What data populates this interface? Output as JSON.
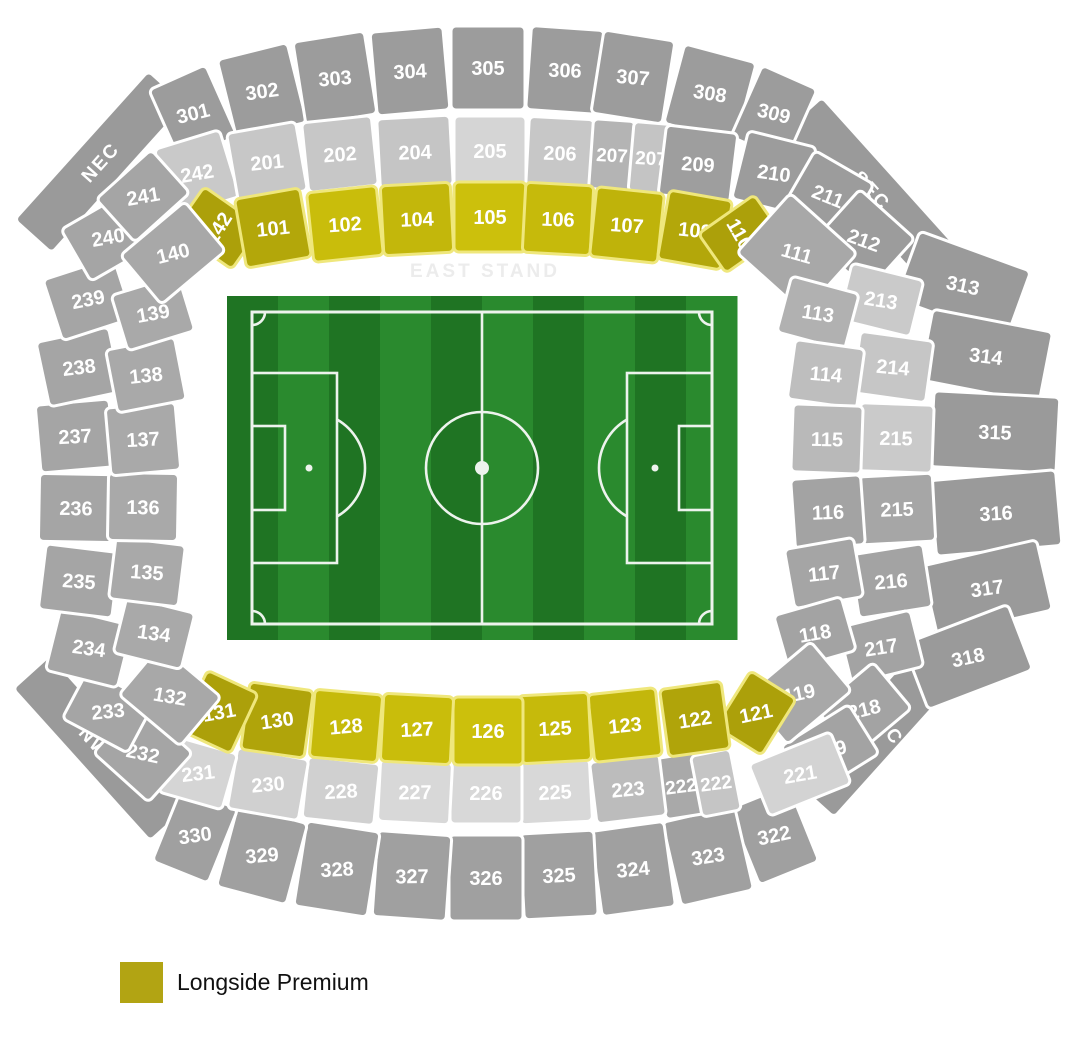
{
  "legend": {
    "label": "Longside Premium",
    "swatch_color": "#B2A413"
  },
  "east_stand_label": {
    "text": "EAST STAND",
    "x": 485,
    "y": 277,
    "color": "#ECECEC",
    "font_size": 19,
    "letter_spacing": 3
  },
  "pitch": {
    "x": 227,
    "y": 296,
    "w": 510,
    "h": 344,
    "stripes": 10,
    "stripe_dark": "#1F7423",
    "stripe_light": "#2A8A2E",
    "line_color": "#EDF3ED"
  },
  "colors": {
    "section_border": "#FFFFFF",
    "premium_border": "#EFE77C",
    "label_color": "#FFFFFF"
  },
  "sections": [
    {
      "id": "nec",
      "label": "NEC",
      "x": 100,
      "y": 162,
      "w": 200,
      "h": 50,
      "rot": -48,
      "lrot": -48,
      "fill": "#9A9A9A",
      "fs": 19,
      "ls": 2,
      "corner": true
    },
    {
      "id": "sec",
      "label": "SEC",
      "x": 872,
      "y": 190,
      "w": 205,
      "h": 50,
      "rot": 48,
      "lrot": 48,
      "fill": "#9A9A9A",
      "fs": 19,
      "ls": 2,
      "corner": true
    },
    {
      "id": "nwc",
      "label": "NWC",
      "x": 100,
      "y": 748,
      "w": 205,
      "h": 50,
      "rot": 48,
      "lrot": 48,
      "fill": "#9A9A9A",
      "fs": 19,
      "ls": 2,
      "corner": true
    },
    {
      "id": "swc",
      "label": "SWC",
      "x": 885,
      "y": 722,
      "w": 210,
      "h": 52,
      "rot": -48,
      "lrot": 55,
      "fill": "#9A9A9A",
      "fs": 19,
      "ls": 2,
      "corner": true
    },
    {
      "id": "301",
      "label": "301",
      "x": 193,
      "y": 113,
      "w": 62,
      "h": 78,
      "rot": -24,
      "lrot": -14,
      "fill": "#9C9C9C"
    },
    {
      "id": "302",
      "label": "302",
      "x": 262,
      "y": 91,
      "w": 72,
      "h": 82,
      "rot": -14,
      "lrot": -8,
      "fill": "#9C9C9C"
    },
    {
      "id": "303",
      "label": "303",
      "x": 335,
      "y": 78,
      "w": 72,
      "h": 84,
      "rot": -9,
      "lrot": -5,
      "fill": "#9C9C9C"
    },
    {
      "id": "304",
      "label": "304",
      "x": 410,
      "y": 71,
      "w": 73,
      "h": 84,
      "rot": -5,
      "lrot": -3,
      "fill": "#9C9C9C"
    },
    {
      "id": "305",
      "label": "305",
      "x": 488,
      "y": 68,
      "w": 74,
      "h": 84,
      "rot": 0,
      "lrot": 0,
      "fill": "#9C9C9C"
    },
    {
      "id": "306",
      "label": "306",
      "x": 565,
      "y": 70,
      "w": 73,
      "h": 84,
      "rot": 4,
      "lrot": 2,
      "fill": "#9C9C9C"
    },
    {
      "id": "307",
      "label": "307",
      "x": 633,
      "y": 77,
      "w": 72,
      "h": 84,
      "rot": 9,
      "lrot": 5,
      "fill": "#9C9C9C"
    },
    {
      "id": "308",
      "label": "308",
      "x": 710,
      "y": 93,
      "w": 74,
      "h": 82,
      "rot": 15,
      "lrot": 9,
      "fill": "#9C9C9C"
    },
    {
      "id": "309",
      "label": "309",
      "x": 774,
      "y": 113,
      "w": 60,
      "h": 78,
      "rot": 24,
      "lrot": 14,
      "fill": "#9C9C9C"
    },
    {
      "id": "313",
      "label": "313",
      "x": 963,
      "y": 285,
      "w": 118,
      "h": 72,
      "rot": 20,
      "lrot": 12,
      "fill": "#9A9A9A"
    },
    {
      "id": "314",
      "label": "314",
      "x": 986,
      "y": 356,
      "w": 122,
      "h": 72,
      "rot": 11,
      "lrot": 7,
      "fill": "#9A9A9A"
    },
    {
      "id": "315",
      "label": "315",
      "x": 995,
      "y": 432,
      "w": 126,
      "h": 76,
      "rot": 3,
      "lrot": 2,
      "fill": "#9A9A9A"
    },
    {
      "id": "316",
      "label": "316",
      "x": 996,
      "y": 513,
      "w": 126,
      "h": 76,
      "rot": -5,
      "lrot": -3,
      "fill": "#9A9A9A"
    },
    {
      "id": "317",
      "label": "317",
      "x": 987,
      "y": 588,
      "w": 118,
      "h": 72,
      "rot": -13,
      "lrot": -8,
      "fill": "#9A9A9A"
    },
    {
      "id": "318",
      "label": "318",
      "x": 968,
      "y": 657,
      "w": 112,
      "h": 70,
      "rot": -21,
      "lrot": -12,
      "fill": "#9A9A9A"
    },
    {
      "id": "322",
      "label": "322",
      "x": 774,
      "y": 835,
      "w": 64,
      "h": 82,
      "rot": -22,
      "lrot": -12,
      "fill": "#A0A0A0"
    },
    {
      "id": "323",
      "label": "323",
      "x": 708,
      "y": 856,
      "w": 74,
      "h": 86,
      "rot": -13,
      "lrot": -9,
      "fill": "#A0A0A0"
    },
    {
      "id": "324",
      "label": "324",
      "x": 633,
      "y": 869,
      "w": 74,
      "h": 86,
      "rot": -8,
      "lrot": -6,
      "fill": "#A0A0A0"
    },
    {
      "id": "325",
      "label": "325",
      "x": 559,
      "y": 875,
      "w": 74,
      "h": 86,
      "rot": -3,
      "lrot": -3,
      "fill": "#A0A0A0"
    },
    {
      "id": "326",
      "label": "326",
      "x": 486,
      "y": 878,
      "w": 74,
      "h": 86,
      "rot": 0,
      "lrot": 0,
      "fill": "#A0A0A0"
    },
    {
      "id": "327",
      "label": "327",
      "x": 412,
      "y": 876,
      "w": 74,
      "h": 86,
      "rot": 4,
      "lrot": -1,
      "fill": "#A0A0A0"
    },
    {
      "id": "328",
      "label": "328",
      "x": 337,
      "y": 869,
      "w": 74,
      "h": 86,
      "rot": 9,
      "lrot": -3,
      "fill": "#A0A0A0"
    },
    {
      "id": "329",
      "label": "329",
      "x": 262,
      "y": 855,
      "w": 72,
      "h": 84,
      "rot": 15,
      "lrot": -5,
      "fill": "#A0A0A0"
    },
    {
      "id": "330",
      "label": "330",
      "x": 195,
      "y": 835,
      "w": 60,
      "h": 80,
      "rot": 22,
      "lrot": -8,
      "fill": "#A0A0A0"
    },
    {
      "id": "242",
      "label": "242",
      "x": 197,
      "y": 173,
      "w": 68,
      "h": 70,
      "rot": -17,
      "lrot": -10,
      "fill": "#C9C9C9"
    },
    {
      "id": "201",
      "label": "201",
      "x": 267,
      "y": 162,
      "w": 70,
      "h": 70,
      "rot": -10,
      "lrot": -6,
      "fill": "#C7C7C7"
    },
    {
      "id": "202",
      "label": "202",
      "x": 340,
      "y": 154,
      "w": 70,
      "h": 70,
      "rot": -6,
      "lrot": -4,
      "fill": "#C7C7C7"
    },
    {
      "id": "204",
      "label": "204",
      "x": 415,
      "y": 152,
      "w": 73,
      "h": 70,
      "rot": -3,
      "lrot": -2,
      "fill": "#C5C5C5"
    },
    {
      "id": "205",
      "label": "205",
      "x": 490,
      "y": 151,
      "w": 72,
      "h": 70,
      "rot": 0,
      "lrot": 0,
      "fill": "#D5D5D5"
    },
    {
      "id": "206",
      "label": "206",
      "x": 560,
      "y": 153,
      "w": 65,
      "h": 70,
      "rot": 3,
      "lrot": 2,
      "fill": "#C7C7C7"
    },
    {
      "id": "207-1",
      "label": "207",
      "x": 612,
      "y": 155,
      "w": 42,
      "h": 70,
      "rot": 4,
      "lrot": 3,
      "fill": "#B4B4B4",
      "fs": 19
    },
    {
      "id": "207-2",
      "label": "207",
      "x": 651,
      "y": 158,
      "w": 40,
      "h": 70,
      "rot": 5,
      "lrot": 3,
      "fill": "#C4C4C4",
      "fs": 19
    },
    {
      "id": "209",
      "label": "209",
      "x": 698,
      "y": 164,
      "w": 72,
      "h": 70,
      "rot": 7,
      "lrot": 4,
      "fill": "#9E9E9E"
    },
    {
      "id": "210",
      "label": "210",
      "x": 774,
      "y": 173,
      "w": 70,
      "h": 70,
      "rot": 14,
      "lrot": 8,
      "fill": "#9C9C9C"
    },
    {
      "id": "211",
      "label": "211",
      "x": 828,
      "y": 196,
      "w": 68,
      "h": 66,
      "rot": 30,
      "lrot": 22,
      "fill": "#9C9C9C"
    },
    {
      "id": "212",
      "label": "212",
      "x": 864,
      "y": 240,
      "w": 74,
      "h": 70,
      "rot": 42,
      "lrot": 20,
      "fill": "#9C9C9C"
    },
    {
      "id": "213",
      "label": "213",
      "x": 881,
      "y": 300,
      "w": 74,
      "h": 58,
      "rot": 14,
      "lrot": 9,
      "fill": "#CACACA"
    },
    {
      "id": "214",
      "label": "214",
      "x": 893,
      "y": 367,
      "w": 74,
      "h": 62,
      "rot": 8,
      "lrot": 5,
      "fill": "#C6C6C6"
    },
    {
      "id": "215-1",
      "label": "215",
      "x": 896,
      "y": 438,
      "w": 74,
      "h": 68,
      "rot": 2,
      "lrot": 1,
      "fill": "#CACACA"
    },
    {
      "id": "215-2",
      "label": "215",
      "x": 897,
      "y": 509,
      "w": 74,
      "h": 68,
      "rot": -3,
      "lrot": -2,
      "fill": "#A6A6A6"
    },
    {
      "id": "216",
      "label": "216",
      "x": 891,
      "y": 581,
      "w": 74,
      "h": 64,
      "rot": -9,
      "lrot": -5,
      "fill": "#A3A3A3"
    },
    {
      "id": "217",
      "label": "217",
      "x": 881,
      "y": 647,
      "w": 74,
      "h": 58,
      "rot": -14,
      "lrot": -9,
      "fill": "#A3A3A3"
    },
    {
      "id": "218",
      "label": "218",
      "x": 864,
      "y": 709,
      "w": 74,
      "h": 60,
      "rot": -40,
      "lrot": -14,
      "fill": "#A3A3A3"
    },
    {
      "id": "219",
      "label": "219",
      "x": 830,
      "y": 750,
      "w": 80,
      "h": 58,
      "rot": -32,
      "lrot": -15,
      "fill": "#A3A3A3"
    },
    {
      "id": "221",
      "label": "221",
      "x": 800,
      "y": 774,
      "w": 88,
      "h": 56,
      "rot": -22,
      "lrot": -10,
      "fill": "#D3D3D3"
    },
    {
      "id": "222-1",
      "label": "222",
      "x": 681,
      "y": 786,
      "w": 40,
      "h": 62,
      "rot": -9,
      "lrot": -7,
      "fill": "#A9A9A9",
      "fs": 19
    },
    {
      "id": "222-2",
      "label": "222",
      "x": 716,
      "y": 783,
      "w": 40,
      "h": 62,
      "rot": -11,
      "lrot": -7,
      "fill": "#C5C5C5",
      "fs": 19
    },
    {
      "id": "223",
      "label": "223",
      "x": 628,
      "y": 789,
      "w": 70,
      "h": 62,
      "rot": -7,
      "lrot": -5,
      "fill": "#BCBCBC"
    },
    {
      "id": "225",
      "label": "225",
      "x": 555,
      "y": 792,
      "w": 72,
      "h": 62,
      "rot": -3,
      "lrot": -3,
      "fill": "#D8D8D8"
    },
    {
      "id": "226",
      "label": "226",
      "x": 486,
      "y": 793,
      "w": 72,
      "h": 62,
      "rot": 0,
      "lrot": 0,
      "fill": "#D8D8D8"
    },
    {
      "id": "227",
      "label": "227",
      "x": 415,
      "y": 792,
      "w": 72,
      "h": 62,
      "rot": 3,
      "lrot": -1,
      "fill": "#D8D8D8"
    },
    {
      "id": "228",
      "label": "228",
      "x": 341,
      "y": 791,
      "w": 72,
      "h": 62,
      "rot": 6,
      "lrot": -3,
      "fill": "#D0D0D0"
    },
    {
      "id": "230",
      "label": "230",
      "x": 268,
      "y": 784,
      "w": 72,
      "h": 62,
      "rot": 10,
      "lrot": -5,
      "fill": "#D0D0D0"
    },
    {
      "id": "231",
      "label": "231",
      "x": 198,
      "y": 773,
      "w": 66,
      "h": 58,
      "rot": 16,
      "lrot": -7,
      "fill": "#D5D5D5"
    },
    {
      "id": "232",
      "label": "232",
      "x": 143,
      "y": 753,
      "w": 74,
      "h": 66,
      "rot": 42,
      "lrot": 12,
      "fill": "#A5A5A5"
    },
    {
      "id": "233",
      "label": "233",
      "x": 108,
      "y": 711,
      "w": 74,
      "h": 56,
      "rot": 28,
      "lrot": -6,
      "fill": "#A5A5A5"
    },
    {
      "id": "234",
      "label": "234",
      "x": 89,
      "y": 648,
      "w": 74,
      "h": 64,
      "rot": 14,
      "lrot": 8,
      "fill": "#A5A5A5"
    },
    {
      "id": "235",
      "label": "235",
      "x": 79,
      "y": 581,
      "w": 74,
      "h": 66,
      "rot": 7,
      "lrot": 4,
      "fill": "#A5A5A5"
    },
    {
      "id": "236",
      "label": "236",
      "x": 76,
      "y": 508,
      "w": 74,
      "h": 68,
      "rot": 1,
      "lrot": 1,
      "fill": "#A5A5A5"
    },
    {
      "id": "237",
      "label": "237",
      "x": 75,
      "y": 436,
      "w": 74,
      "h": 68,
      "rot": -5,
      "lrot": -3,
      "fill": "#A5A5A5"
    },
    {
      "id": "238",
      "label": "238",
      "x": 79,
      "y": 367,
      "w": 74,
      "h": 66,
      "rot": -12,
      "lrot": -7,
      "fill": "#A5A5A5"
    },
    {
      "id": "239",
      "label": "239",
      "x": 88,
      "y": 299,
      "w": 74,
      "h": 64,
      "rot": -18,
      "lrot": -11,
      "fill": "#A5A5A5"
    },
    {
      "id": "240",
      "label": "240",
      "x": 108,
      "y": 237,
      "w": 74,
      "h": 60,
      "rot": -30,
      "lrot": -10,
      "fill": "#A5A5A5"
    },
    {
      "id": "241",
      "label": "241",
      "x": 143,
      "y": 196,
      "w": 74,
      "h": 58,
      "rot": -42,
      "lrot": -10,
      "fill": "#A5A5A5"
    },
    {
      "id": "142",
      "label": "142",
      "x": 218,
      "y": 228,
      "w": 52,
      "h": 70,
      "rot": -55,
      "lrot": -58,
      "fill": "#ACA00A",
      "premium": true
    },
    {
      "id": "101",
      "label": "101",
      "x": 273,
      "y": 228,
      "w": 66,
      "h": 70,
      "rot": -10,
      "lrot": -6,
      "fill": "#B3A70A",
      "premium": true
    },
    {
      "id": "102",
      "label": "102",
      "x": 345,
      "y": 224,
      "w": 70,
      "h": 70,
      "rot": -6,
      "lrot": -4,
      "fill": "#C9BD0B",
      "premium": true
    },
    {
      "id": "104",
      "label": "104",
      "x": 417,
      "y": 219,
      "w": 70,
      "h": 70,
      "rot": -3,
      "lrot": -2,
      "fill": "#C3B70B",
      "premium": true
    },
    {
      "id": "105",
      "label": "105",
      "x": 490,
      "y": 217,
      "w": 72,
      "h": 70,
      "rot": 0,
      "lrot": 0,
      "fill": "#CCC00C",
      "premium": true
    },
    {
      "id": "106",
      "label": "106",
      "x": 558,
      "y": 219,
      "w": 68,
      "h": 70,
      "rot": 3,
      "lrot": 2,
      "fill": "#C6BA0B",
      "premium": true
    },
    {
      "id": "107",
      "label": "107",
      "x": 627,
      "y": 225,
      "w": 68,
      "h": 70,
      "rot": 6,
      "lrot": 4,
      "fill": "#BFB30A",
      "premium": true
    },
    {
      "id": "109",
      "label": "109",
      "x": 695,
      "y": 230,
      "w": 64,
      "h": 70,
      "rot": 10,
      "lrot": 6,
      "fill": "#B3A70A",
      "premium": true
    },
    {
      "id": "110",
      "label": "110",
      "x": 740,
      "y": 234,
      "w": 48,
      "h": 68,
      "rot": 55,
      "lrot": 60,
      "fill": "#ACA00A",
      "premium": true
    },
    {
      "id": "111",
      "label": "111",
      "x": 797,
      "y": 253,
      "w": 90,
      "h": 80,
      "rot": 42,
      "lrot": 16,
      "fill": "#A8A8A8"
    },
    {
      "id": "113",
      "label": "113",
      "x": 818,
      "y": 313,
      "w": 70,
      "h": 58,
      "rot": 15,
      "lrot": 9,
      "fill": "#B1B1B1"
    },
    {
      "id": "114",
      "label": "114",
      "x": 826,
      "y": 374,
      "w": 70,
      "h": 60,
      "rot": 8,
      "lrot": 5,
      "fill": "#BEBEBE"
    },
    {
      "id": "115",
      "label": "115",
      "x": 827,
      "y": 439,
      "w": 70,
      "h": 68,
      "rot": 2,
      "lrot": 1,
      "fill": "#B9B9B9"
    },
    {
      "id": "116",
      "label": "116",
      "x": 828,
      "y": 512,
      "w": 70,
      "h": 70,
      "rot": -4,
      "lrot": -2,
      "fill": "#A3A3A3"
    },
    {
      "id": "117",
      "label": "117",
      "x": 824,
      "y": 573,
      "w": 70,
      "h": 60,
      "rot": -10,
      "lrot": -6,
      "fill": "#A5A5A5"
    },
    {
      "id": "118",
      "label": "118",
      "x": 815,
      "y": 633,
      "w": 70,
      "h": 56,
      "rot": -16,
      "lrot": -10,
      "fill": "#A3A3A3"
    },
    {
      "id": "119",
      "label": "119",
      "x": 799,
      "y": 693,
      "w": 84,
      "h": 64,
      "rot": -40,
      "lrot": -12,
      "fill": "#A8A8A8"
    },
    {
      "id": "121",
      "label": "121",
      "x": 756,
      "y": 713,
      "w": 54,
      "h": 66,
      "rot": 32,
      "lrot": -12,
      "fill": "#ACA00A",
      "premium": true
    },
    {
      "id": "122",
      "label": "122",
      "x": 695,
      "y": 719,
      "w": 62,
      "h": 68,
      "rot": -8,
      "lrot": -9,
      "fill": "#B0A40A",
      "premium": true
    },
    {
      "id": "123",
      "label": "123",
      "x": 625,
      "y": 725,
      "w": 68,
      "h": 68,
      "rot": -6,
      "lrot": -6,
      "fill": "#C3B70B",
      "premium": true
    },
    {
      "id": "125",
      "label": "125",
      "x": 555,
      "y": 728,
      "w": 70,
      "h": 68,
      "rot": -3,
      "lrot": -3,
      "fill": "#C6BA0B",
      "premium": true
    },
    {
      "id": "126",
      "label": "126",
      "x": 488,
      "y": 731,
      "w": 70,
      "h": 68,
      "rot": 0,
      "lrot": 0,
      "fill": "#CCC00C",
      "premium": true
    },
    {
      "id": "127",
      "label": "127",
      "x": 417,
      "y": 729,
      "w": 70,
      "h": 68,
      "rot": 3,
      "lrot": -3,
      "fill": "#C9BD0B",
      "premium": true
    },
    {
      "id": "128",
      "label": "128",
      "x": 346,
      "y": 726,
      "w": 68,
      "h": 68,
      "rot": 5,
      "lrot": -5,
      "fill": "#C6BA0B",
      "premium": true
    },
    {
      "id": "130",
      "label": "130",
      "x": 277,
      "y": 720,
      "w": 64,
      "h": 68,
      "rot": 8,
      "lrot": -8,
      "fill": "#B0A40A",
      "premium": true
    },
    {
      "id": "131",
      "label": "131",
      "x": 219,
      "y": 712,
      "w": 56,
      "h": 66,
      "rot": 25,
      "lrot": -10,
      "fill": "#ACA00A",
      "premium": true
    },
    {
      "id": "132",
      "label": "132",
      "x": 170,
      "y": 696,
      "w": 80,
      "h": 64,
      "rot": 40,
      "lrot": 10,
      "fill": "#A8A8A8"
    },
    {
      "id": "134",
      "label": "134",
      "x": 154,
      "y": 633,
      "w": 70,
      "h": 58,
      "rot": 14,
      "lrot": 8,
      "fill": "#A9A9A9"
    },
    {
      "id": "135",
      "label": "135",
      "x": 147,
      "y": 572,
      "w": 70,
      "h": 62,
      "rot": 7,
      "lrot": 4,
      "fill": "#A9A9A9"
    },
    {
      "id": "136",
      "label": "136",
      "x": 143,
      "y": 507,
      "w": 70,
      "h": 68,
      "rot": 1,
      "lrot": 1,
      "fill": "#A9A9A9"
    },
    {
      "id": "137",
      "label": "137",
      "x": 143,
      "y": 439,
      "w": 70,
      "h": 68,
      "rot": -5,
      "lrot": -3,
      "fill": "#A9A9A9"
    },
    {
      "id": "138",
      "label": "138",
      "x": 146,
      "y": 375,
      "w": 70,
      "h": 64,
      "rot": -11,
      "lrot": -6,
      "fill": "#A9A9A9"
    },
    {
      "id": "139",
      "label": "139",
      "x": 153,
      "y": 313,
      "w": 70,
      "h": 58,
      "rot": -17,
      "lrot": -10,
      "fill": "#A9A9A9"
    },
    {
      "id": "140",
      "label": "140",
      "x": 173,
      "y": 253,
      "w": 84,
      "h": 64,
      "rot": -40,
      "lrot": -14,
      "fill": "#A8A8A8"
    }
  ]
}
